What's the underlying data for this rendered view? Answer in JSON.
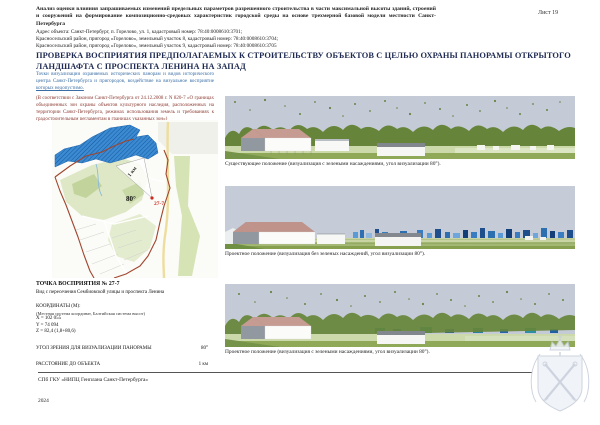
{
  "sheet_label": "Лист 19",
  "header": {
    "title": "Анализ оценки влияния запрашиваемых изменений предельных параметров разрешенного строительства в части максимальной высоты зданий, строений и сооружений на формирование композиционно-средовых характеристик городской среды на основе трехмерной базовой модели местности Санкт-Петербурга",
    "address_lines": [
      "Адрес объекта: Санкт-Петербург, п. Горелово, ул. 1, кадастровый номер: 78:40:0008610:3701;",
      "Красносельский район, пригород «Горелово», земельный участок 8, кадастровый номер: 78:40:0008610:3704;",
      "Красносельский район, пригород «Горелово», земельный участок 9, кадастровый номер: 78:40:0008610:3705"
    ]
  },
  "main_heading": "ПРОВЕРКА ВОСПРИЯТИЯ ПРЕДПОЛАГАЕМЫХ К СТРОИТЕЛЬСТВУ ОБЪЕКТОВ С ЦЕЛЬЮ ОХРАНЫ ПАНОРАМЫ ОТКРЫТОГО ЛАНДШАФТА С ПРОСПЕКТА ЛЕНИНА НА ЗАПАД",
  "intro": {
    "viz_text": "Точки визуализации охраняемых исторических панорам и видов исторического центра Санкт-Петербурга и пригородов, воздействие на визуальное восприятие",
    "viz_underlined": "которых недопустимо.",
    "law_reference": "(В соответствии с Законом Санкт-Петербурга от 24.12.2008 г. N 820-7 «О границах объединенных зон охраны объектов культурного наследия, расположенных на территории Санкт-Петербурга, режимах использования земель и требованиях к градостроительным регламентам в границах указанных зон»)"
  },
  "map": {
    "angle_label": "80°",
    "point_label": "27-7",
    "distance_label": "1 км"
  },
  "viewpoint": {
    "title": "ТОЧКА ВОСПРИЯТИЯ № 27-7",
    "subtitle": "Вид с пересечения Сембиовской улицы и проспекта Ленина",
    "coords_heading": "КООРДИНАТЫ (М):",
    "coords_note": "(Местная система координат, Балтийская система высот)",
    "coord_x": "X = 102 055",
    "coord_y": "Y = 74 094",
    "coord_z": "Z = 82,4 (1,8+80,6)",
    "angle_label": "УГОЛ ЗРЕНИЯ ДЛЯ ВИЗУАЛИЗАЦИИ ПАНОРАМЫ",
    "angle_value": "80°",
    "distance_label": "РАССТОЯНИЕ ДО ОБЪЕКТА",
    "distance_value": "1 км"
  },
  "panoramas": [
    {
      "name": "existing-with-greenery",
      "caption": "Существующее положение (визуализация с зелеными насаждениями, угол визуализации 80°)."
    },
    {
      "name": "project-without-greenery",
      "caption": "Проектное положение (визуализация без зеленых насаждений, угол визуализации 80°)."
    },
    {
      "name": "project-with-greenery",
      "caption": "Проектное положение (визуализация с зелеными насаждениями, угол визуализации 80°)."
    }
  ],
  "footer": {
    "organization": "СПб ГКУ «НИПЦ Генплана Санкт-Петербурга»",
    "year": "2024"
  },
  "colors": {
    "heading_navy": "#1e2a52",
    "intro_blue": "#3a6ea5",
    "law_red": "#8a3a32",
    "map_protected_blue": "#3b8ad2",
    "map_boundary_red": "#a0452e",
    "point_red": "#cc2a1f",
    "project_building_blue": "#2e6fb0",
    "sky_gray": "#c5cad7",
    "tree_green": "#66853a"
  }
}
